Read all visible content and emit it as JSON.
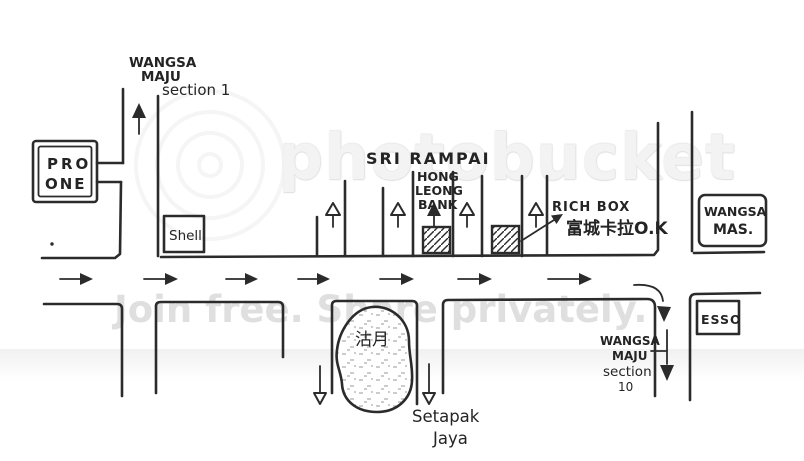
{
  "page": {
    "background": "#ffffff",
    "ink_color": "#2b2b2b"
  },
  "watermark": {
    "brand": "photobucket",
    "tagline": "Join free. Share privately.",
    "text_color": "#f3f3f3",
    "tagline_color": "#dcdcdc"
  },
  "map": {
    "labels": {
      "wangsa_maju_1": {
        "line1": "WANGSA",
        "line2": "MAJU",
        "line3": "section 1"
      },
      "pro_one": {
        "line1": "PRO",
        "line2": "ONE"
      },
      "shell": "Shell",
      "sri_rampai": "SRI RAMPAI",
      "hong_leong_bank": {
        "line1": "HONG",
        "line2": "LEONG",
        "line3": "BANK"
      },
      "rich_box": {
        "name": "RICH BOX",
        "chinese": "富城卡拉O.K"
      },
      "wangsa_mas": {
        "line1": "WANGSA",
        "line2": "MAS."
      },
      "esso": "ESSO",
      "lake": "沽月",
      "setapak_jaya": {
        "line1": "Setapak",
        "line2": "Jaya"
      },
      "wangsa_maju_10": {
        "line1": "WANGSA",
        "line2": "MAJU",
        "line3": "section",
        "line4": "10"
      }
    }
  }
}
